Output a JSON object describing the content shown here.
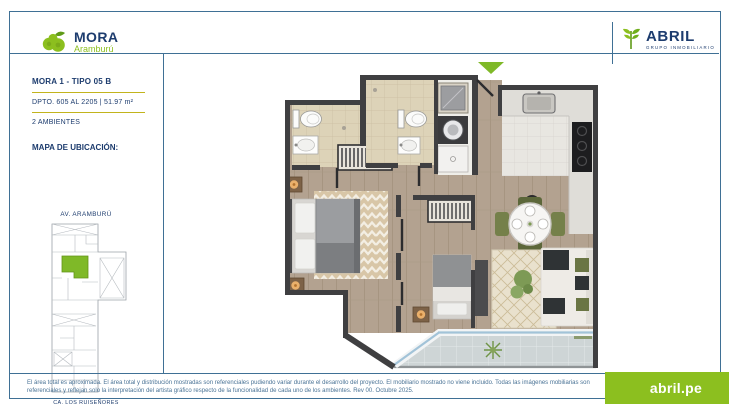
{
  "header": {
    "project": {
      "name": "MORA",
      "location": "Aramburú"
    },
    "developer": {
      "name": "ABRIL",
      "tagline": "GRUPO INMOBILIARIO"
    }
  },
  "sidebar": {
    "unit_title": "MORA 1 - TIPO 05 B",
    "unit_info": "DPTO. 605 AL 2205  |  51.97 m²",
    "rooms": "2 AMBIENTES",
    "map_heading": "MAPA DE UBICACIÓN:",
    "street_top": "AV. ARAMBURÚ",
    "street_bottom": "CA. LOS RUISEÑORES"
  },
  "footer": {
    "disclaimer_line1": "El área total es aproximada. El área total y distribución mostradas son referenciales pudiendo variar durante el desarrollo del proyecto. El mobiliario mostrado no viene incluido. Todas las imágenes",
    "disclaimer_line2": "mobiliarias son referenciales y reflejan solo la interpretación del artista gráfico respecto de la funcionalidad de cada uno de los ambientes. Rev 00. Octubre 2025.",
    "website": "abril.pe"
  },
  "colors": {
    "brand_green": "#8cbf1f",
    "navy": "#1d3c6e",
    "frame_blue": "#3f7095",
    "accent_yellow": "#c2b41d",
    "wall_gray": "#3f3f41",
    "unit_highlight_green": "#7fb928"
  }
}
